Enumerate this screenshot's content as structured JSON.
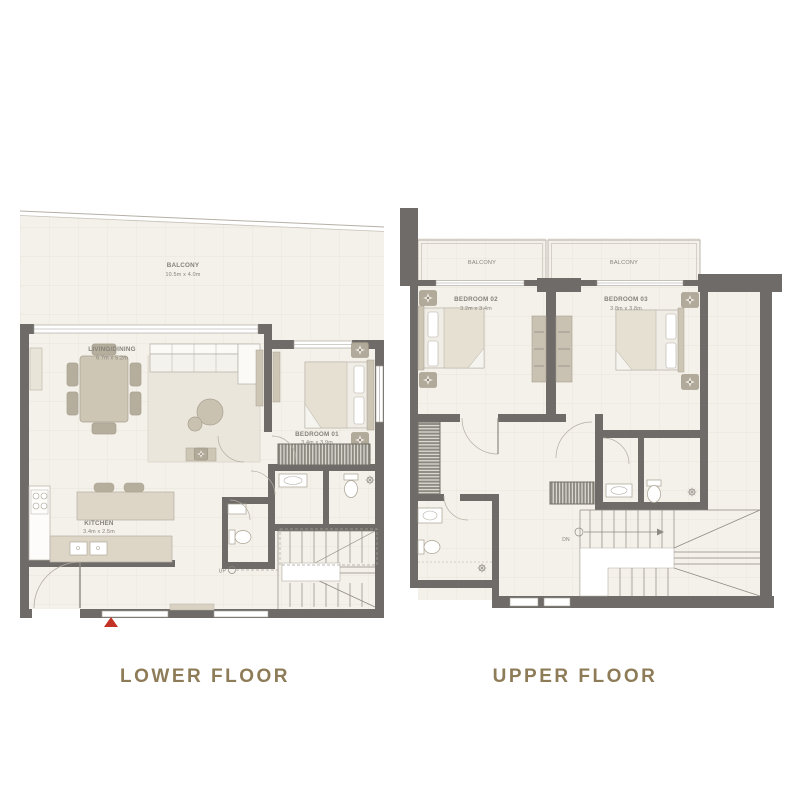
{
  "colors": {
    "wall": "#6e6b68",
    "floor": "#f4f1ea",
    "grid": "#e6e1d6",
    "furniture": "#cdc6b5",
    "furniture_dark": "#b6ae9d",
    "caption_text": "#8e7c58",
    "room_label_text": "#85827a",
    "entry_marker": "#c23326"
  },
  "plans": {
    "lower": {
      "caption": "LOWER FLOOR",
      "balcony": {
        "label": "BALCONY",
        "dims": "10.5m x 4.0m"
      },
      "living": {
        "label": "LIVING/DINING",
        "dims": "6.7m x 5.2m"
      },
      "bedroom01": {
        "label": "BEDROOM 01",
        "dims": "3.4m x 3.9m"
      },
      "kitchen": {
        "label": "KITCHEN",
        "dims": "3.4m x 2.5m"
      },
      "stair_label": "UP"
    },
    "upper": {
      "caption": "UPPER FLOOR",
      "balcony_left": {
        "label": "BALCONY"
      },
      "balcony_right": {
        "label": "BALCONY"
      },
      "bedroom02": {
        "label": "BEDROOM 02",
        "dims": "3.2m x 3.4m"
      },
      "bedroom03": {
        "label": "BEDROOM 03",
        "dims": "3.8m x 3.8m"
      },
      "stair_label": "DN"
    }
  }
}
